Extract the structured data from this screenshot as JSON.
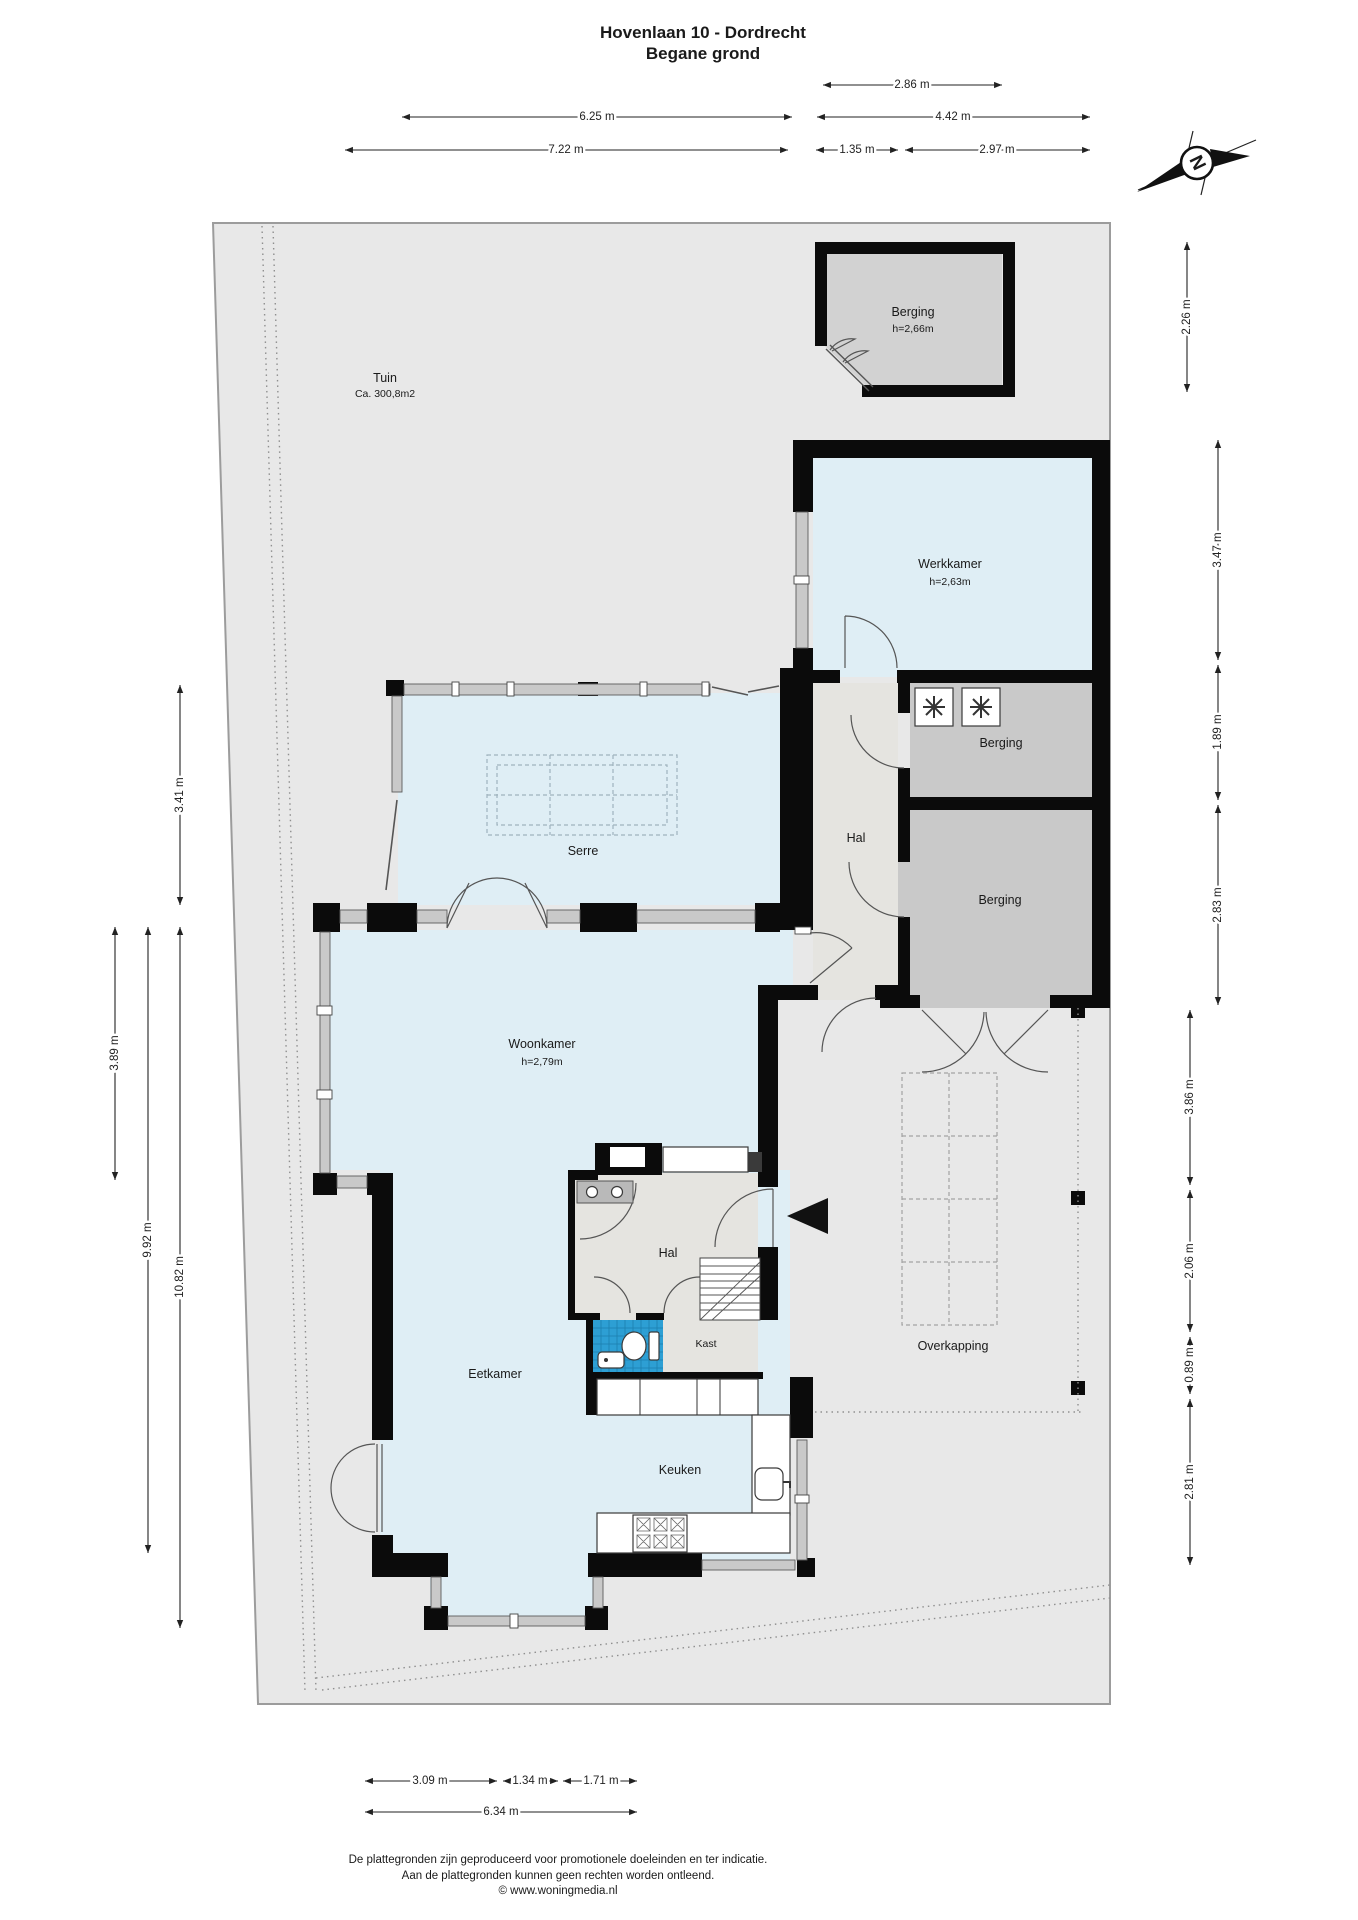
{
  "title": {
    "line1": "Hovenlaan 10 - Dordrecht",
    "line2": "Begane grond"
  },
  "compass": {
    "letter": "N"
  },
  "rooms": {
    "tuin": {
      "name": "Tuin",
      "area": "Ca. 300,8m2"
    },
    "berging_tuin": {
      "name": "Berging",
      "height": "h=2,66m"
    },
    "werkkamer": {
      "name": "Werkkamer",
      "height": "h=2,63m"
    },
    "berging_1": {
      "name": "Berging"
    },
    "hal_noord": {
      "name": "Hal"
    },
    "berging_2": {
      "name": "Berging"
    },
    "serre": {
      "name": "Serre"
    },
    "woonkamer": {
      "name": "Woonkamer",
      "height": "h=2,79m"
    },
    "hal_zuid": {
      "name": "Hal"
    },
    "kast": {
      "name": "Kast"
    },
    "eetkamer": {
      "name": "Eetkamer"
    },
    "keuken": {
      "name": "Keuken"
    },
    "overkapping": {
      "name": "Overkapping"
    }
  },
  "dimensions": {
    "top": [
      "2.86 m",
      "6.25 m",
      "4.42 m",
      "7.22 m",
      "1.35 m",
      "2.97 m"
    ],
    "right": [
      "2.26 m",
      "3.47 m",
      "1.89 m",
      "2.83 m",
      "3.86 m",
      "2.06 m",
      "0.89 m",
      "2.81 m"
    ],
    "left": [
      "3.41 m",
      "3.89 m",
      "9.92 m",
      "10.82 m"
    ],
    "bottom": [
      "3.09 m",
      "1.34 m",
      "1.71 m",
      "6.34 m"
    ]
  },
  "footer": {
    "line1": "De plattegronden zijn geproduceerd voor promotionele doeleinden en ter indicatie.",
    "line2": "Aan de plattegronden kunnen geen rechten worden ontleend.",
    "line3": "© www.woningmedia.nl"
  },
  "colors": {
    "wall": "#0b0b0b",
    "garden": "#e8e8e8",
    "room_blue": "#dfeef5",
    "hall_grey": "#e5e4e0",
    "storage_grey": "#c9c9c9",
    "shed_grey": "#d2d2d2",
    "toilet_blue": "#2d9fd4"
  }
}
